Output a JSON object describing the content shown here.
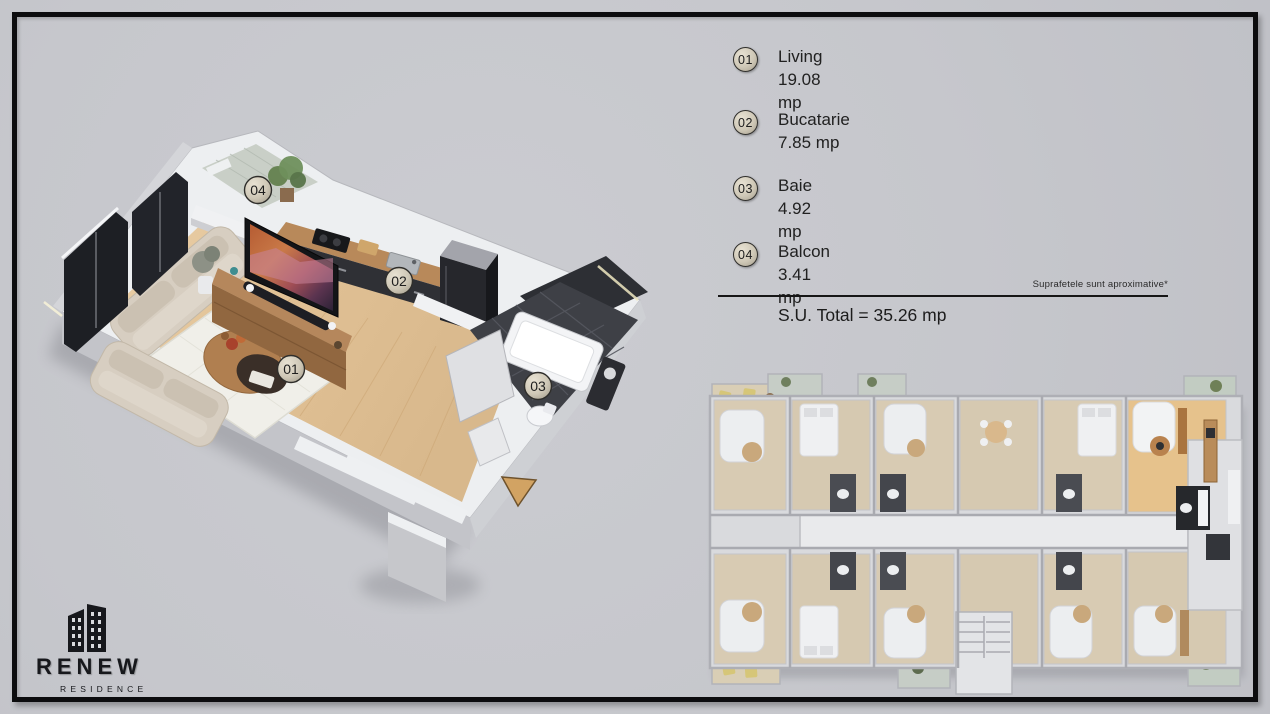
{
  "title": "Renew Residence - studio apartment floor plan",
  "legend": {
    "items": [
      {
        "number": "01",
        "label": "Living",
        "area": "19.08 mp"
      },
      {
        "number": "02",
        "label": "Bucatarie",
        "area": "7.85 mp"
      },
      {
        "number": "03",
        "label": "Baie",
        "area": "4.92 mp"
      },
      {
        "number": "04",
        "label": "Balcon",
        "area": "3.41 mp"
      }
    ],
    "note": "Suprafetele sunt aproximative*",
    "total": "S.U. Total = 35.26 mp"
  },
  "logo": {
    "name": "RENEW",
    "subtitle": "RESIDENCE"
  },
  "colors": {
    "background": "#c6c7cc",
    "frame": "#0c0c0e",
    "text": "#212121",
    "badge_fill": "#cfc8b7",
    "wood_floor": "#e3c89e",
    "kitchen_dark": "#303136",
    "bathroom_tile": "#3e4046",
    "sofa_beige": "#d7cec1",
    "balcony_tile": "#c9cfc7",
    "arrow_entrance": "#d2a363",
    "highlight_unit_floor": "#e6c28c"
  }
}
